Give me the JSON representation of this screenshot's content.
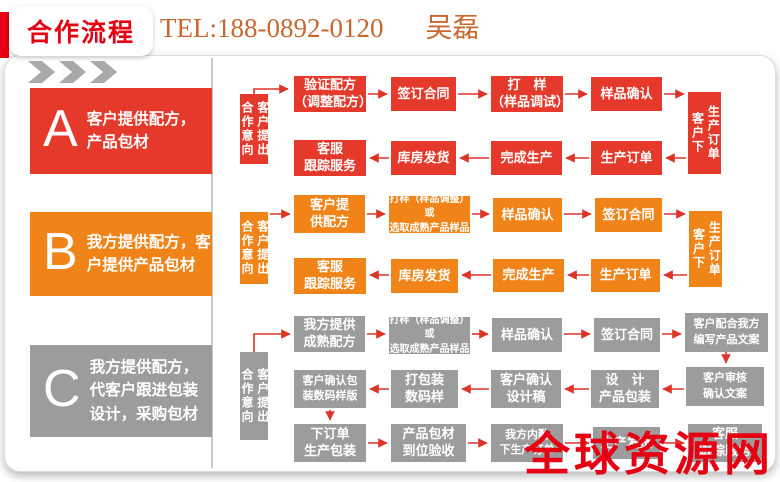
{
  "header": {
    "badge": "合作流程",
    "tel": "TEL:188-0892-0120",
    "contact": "吴磊"
  },
  "watermark": "全球资源网",
  "colors": {
    "flow_a_red": "#e53a2b",
    "flow_b_orange": "#f08418",
    "flow_c_gray": "#9c9c9c",
    "accent_red": "#e60012",
    "tel_orange": "#c8672f",
    "arrow_red": "#dc3428",
    "chevron_gray": "#a9a9a9"
  },
  "sections": [
    {
      "letter": "A",
      "desc": "客户提供配方，\n产品包材"
    },
    {
      "letter": "B",
      "desc": "我方提供配方，客\n户提供产品包材"
    },
    {
      "letter": "C",
      "desc": "我方提供配方，\n代客户跟进包装\n设计，采购包材"
    }
  ],
  "flows": {
    "a": {
      "start": {
        "left": "合作意向",
        "right": "客户提出"
      },
      "end": {
        "left": "客户下",
        "right": "生产订单"
      },
      "row1": [
        "验证配方\n（调整配方）",
        "签订合同",
        "打　样\n（样品调试）",
        "样品确认"
      ],
      "row2": [
        "客服\n跟踪服务",
        "库房发货",
        "完成生产",
        "生产订单"
      ]
    },
    "b": {
      "start": {
        "left": "合作意向",
        "right": "客户提出"
      },
      "end": {
        "left": "客户下",
        "right": "生产订单"
      },
      "row1": [
        "客户提\n供配方",
        "打样（样品调整）或\n选取成熟产品样品",
        "样品确认",
        "签订合同"
      ],
      "row2": [
        "客服\n跟踪服务",
        "库房发货",
        "完成生产",
        "生产订单"
      ]
    },
    "c": {
      "start": {
        "left": "合作意向",
        "right": "客户提出"
      },
      "row1": [
        "我方提供\n成熟配方",
        "打样（样品调整）或\n选取成熟产品样品",
        "样品确认",
        "签订合同",
        "客户配合我方\n编写产品文案"
      ],
      "row2": [
        "客户确认包\n装数码样版",
        "打包装\n数码样",
        "客户确认\n设计稿",
        "设　计\n产品包装",
        "客户审核\n确认文案"
      ],
      "row3": [
        "下订单\n生产包装",
        "产品包材\n到位验收",
        "我方内勤\n下生产订单",
        "生产发货",
        "客服\n跟踪服务"
      ]
    }
  }
}
